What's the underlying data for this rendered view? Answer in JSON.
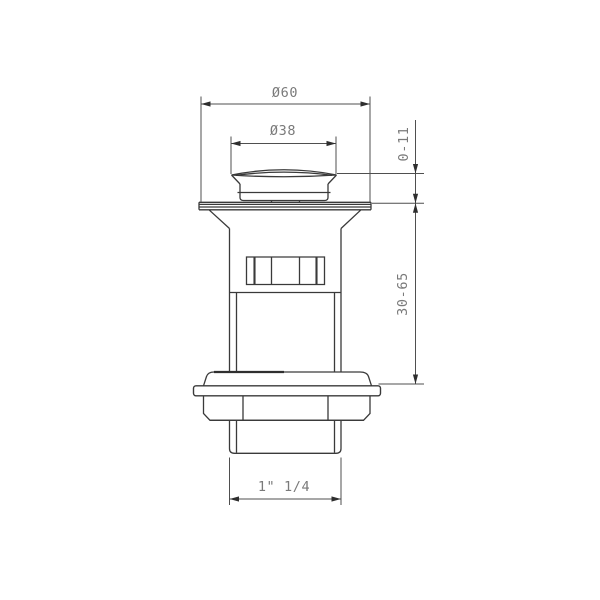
{
  "figure": {
    "background_color": "#ffffff",
    "outline_color": "#3a3a3a",
    "dimension_line_color": "#4f4f4f",
    "label_color": "#7a7a7a"
  },
  "dimensions": {
    "outer_diameter": "Ø60",
    "cap_diameter": "Ø38",
    "pop_up_travel": "0-11",
    "installation_length": "30-65",
    "thread_size": "1\" 1/4"
  }
}
